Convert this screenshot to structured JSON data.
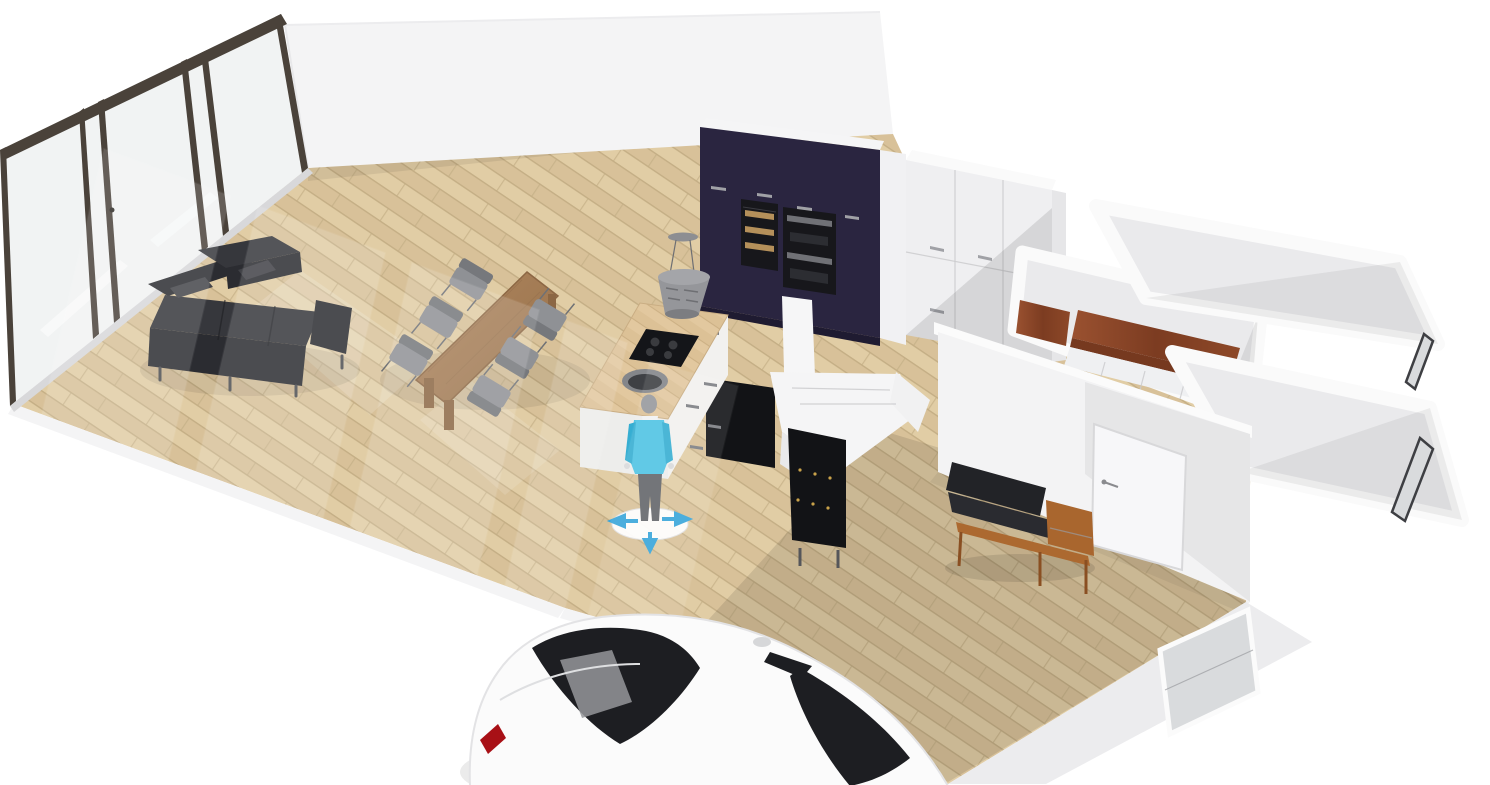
{
  "scene": {
    "type": "floor-plan-3d-view",
    "rooms": [
      "living-room",
      "kitchen",
      "hallway",
      "closet-room",
      "room-upper-right",
      "room-middle-right",
      "room-lower-right"
    ],
    "objects": [
      "glass-door-wall",
      "back-wall",
      "sectional-sofa",
      "dining-table",
      "dining-chairs",
      "kitchen-island",
      "cooktop",
      "sink",
      "pendant-hood",
      "navy-cabinet-wall",
      "wine-cooler",
      "double-oven",
      "tall-white-unit",
      "wardrobe",
      "closet-counters",
      "staircase",
      "dark-cabinet",
      "bench-with-cushions",
      "interior-door",
      "windows",
      "person-figure",
      "move-gizmo",
      "car"
    ]
  },
  "colors": {
    "bg": "#ffffff",
    "back_wall": "#f4f4f5",
    "wall": "#f3f3f4",
    "wall_band": "#fafafa",
    "wall_shade": "#e3e3e6",
    "room_floor": "#eaeaec",
    "floor_a": "#e1cda5",
    "floor_b": "#d8c199",
    "floor_line": "#c4ae85",
    "glass_frame": "#4a423a",
    "glass_pane": "#f0f2f2",
    "navy": "#2a2540",
    "navy_dark": "#1f1b31",
    "appliance": "#17171b",
    "bottle": "#c79d62",
    "handle": "#a0a1a6",
    "unit_white": "#f1f1f3",
    "wardrobe": "#efeff1",
    "closet_wood": "#91492a",
    "closet_wood_dark": "#76391f",
    "cabinet_front": "#eff0f2",
    "sofa": "#36373c",
    "sofa_dark": "#2b2c31",
    "chair": "#8f9195",
    "chair_dark": "#76787c",
    "table_wood": "#a87e56",
    "table_wood_dark": "#8c6744",
    "island_body": "#f2f1ef",
    "island_top": "#dfc59d",
    "cooktop": "#141519",
    "sink_outer": "#84868a",
    "sink_inner": "#3e4044",
    "hood": "#95969a",
    "hood_dark": "#7c7d81",
    "stair": "#f5f5f6",
    "dark_box": "#121316",
    "stud_gold": "#c9a24a",
    "bench_wood": "#ac6930",
    "bench_cushion": "#222327",
    "door": "#f7f7f9",
    "door_handle": "#8a8b8f",
    "window_frame": "#3e3f43",
    "window_glass": "#d9dbdd",
    "person_shirt": "#4fc3e4",
    "person_shirt_dark": "#36aed2",
    "person_pants": "#63656a",
    "person_head": "#97999d",
    "person_collar": "#f1f2f3",
    "gizmo": "#38a5da",
    "gizmo_disc": "#ffffff",
    "car_body": "#fbfbfb",
    "car_line": "#dedfe1",
    "car_glass": "#1d1e22",
    "car_glass_hl": "#95969a",
    "car_red": "#a81016"
  }
}
